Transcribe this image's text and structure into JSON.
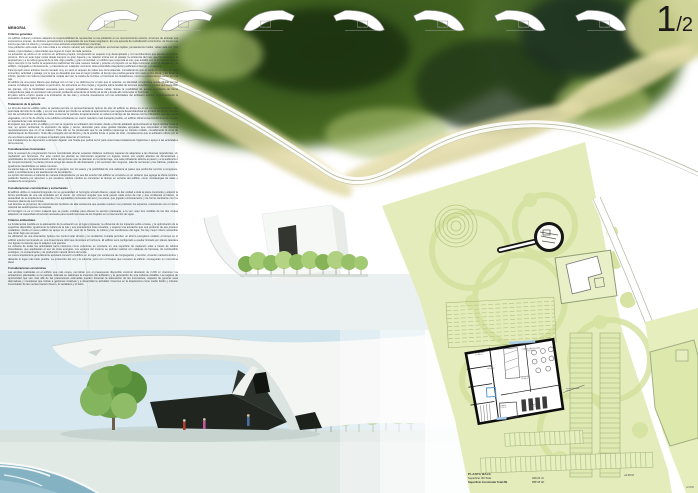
{
  "page": {
    "number_large": "1",
    "number_small": "/2"
  },
  "memoria": {
    "title": "MEMORIA",
    "sections": [
      {
        "heading": "Criterios generales",
        "body": "Un edificio cultural y turístico adquiere la responsabilidad de representar a una población en su reconocimiento exterior, al tiempo de articular sus expresiones propias, de distintos pensamientos e inquietudes de sus líneas singulares. Es una apuesta de revitalización económica, de frenar una inercia que late en silencio y conseguir unas acciones emprendedoras y lectoras.\nUna población está cada vez más unida a su entorno natural; son cuales permitirán economías tejidas, pensamientos bellos, vidas cada vez más reales, improvisadas y optimizadas que logran lo mejor de cada persona.\nLa actuación se ubica en un entorno sin atributos propios, recuperando un espacio muy desempleado y con servidumbres que afectan al entorno próximo. Pero en este lugar existe desde siempre su gran riqueza y su relación íntima con el paisaje: la existencia del mar, que ha inspirado a la arquitectura y a la cultura general de la isla. Algo posible y gran comunidad, un edificio que responda al mar, que entable con él un intenso diálogo como siempre lo ha hecho la arquitectura tradicional. De esta manera natural y potente el proyecto no se deja reconocer entre la naturaleza y el artificio, conjugado e intensamente, y entenderse en cualquier momento. Esta pretendida integración justificará el tiempo y el espacio.\nPara cumplir estos anhelos hemos tomado muy en serio el amparo de todas sus circunstancias. Consideramos que el suelo es un valor de vida, encuentro, actividad y paisaje, por lo que es deseable que sea el mayor posible, al tiempo que podría generar otro suelo a otra altura, y así llegar al infinito, percibir con toda la intensidad la mirada del mar, la caricia de la brisa, el horizonte sin limitaciones, como la problemática exterior de una isla.\nEl edificio es una pieza blanca que dialoga con el mar y se deforma por el aire que lo acaricia. La identidad constructiva queda diluida por las suaves curvaturas que modelan su perímetro. Se estructura en dos crujías y organiza sobre huellas de terrenos sensibles a medida que ascienden las plantas, con la flexibilidad necesaria para recoger actividades de diversa índole. Existe la posibilidad de acceso a cubierta de forma independiente para un acontecer más puntual, pudiendo extenderse al borde de la ola y desde allí contemplar el horizonte.\nEl palco sobre el arco queda a la inclinación de las olas y conecta visualmente con las actividades del anfiteatro exterior, experimentando la sensación de estar sobre el mar."
      },
      {
        "heading": "Tratamiento de la parcela",
        "body": "La fórmula dual de edificio sobre la parcela permite un aprovechamiento óptimo de ella. El edificio se alinea en el sur con la construcción más avanzada del sitio de la calle, y es por ese lateral por donde se accede al aparcamiento que seguirá desarrollándose en el talud del litoral, a limitar con las servidumbres vecinas que debe conservar la parcela. El aparcamiento se ordena al abrigo de las alturas con la ordenación que las plazas vegetadas, con el fin de ofrecer a los edificios colindantes un marco natural lo más tranquilo posible, un edificio oficial excepcionalmente de mesura en arquitecturas más domésticas.\nEl espacio que gira entre el edificio y el mar se organiza en anfiteatro del mirador, desde el borde asfaltado aprovechando el ligero declive hacia el mar; un aporte ambiental, la evocación de algas y arena, decorado para unas gradas blandas apoyadas que respondan a las diversas representaciones que en él se realicen. Para ello se ha preservado que la vía pública mantenga su tránsito rodado, considerando la zona de deslizamiento de liberación. Todo ello protegido del sol directo y de la posible lluvia. A pesar de todo, consideramos que el anfiteatro ofrece por la vía una buena parada en el paseo inmediato para observar el horizonte.\nLas instalaciones de depuración a demoler dejarán una huella que podría servir para unas losas-instalaciones higiénicas o apoyo a las actividades de la escena."
      },
      {
        "heading": "Consideraciones funcionales",
        "body": "Ante la escasez de programación hemos considerado ofrecer espacios diáfanos multiusos capaces de adaptarse a las diversas requisitorias, sin mediatizar sus funciones. Por este motivo las plantas se intencionan organizar en lugares únicos con amplio abanico de dimensiones y posibilidades de compartimentación. Entre las opciones que se plantean en la planta baja, una sala polivalente abierta al paseo y a la audiencia o de complementación; la planta primera acoge las áreas de administración y los servicios del congreso, sala de reuniones y las cabinas, pudiendo igualmente desdoblarse en salas menores.\nLa planta baja se ha destinado a restituir lo general, con los aseos y la posibilidad de una cafetería al paseo que podrá dar servicio a congresos, salón o sencillamente a los atardeceres de la población.\nLa opción del acceso a cubierta de manera independiente ya sea del exterior del edificio se convierte en un reclamo que agrega la oferta turística, pudiendo hacerlo por ascensor o por escalera. Ambos medios se convierten al tiempo en servicio del edificio, como montacargas de salas o escalera de emergencia."
      },
      {
        "heading": "Consideraciones constructivas y estructurales",
        "body": "El edificio utiliza un material integrado con su generalidad: el hormigón armado blanco, capaz de dar unidad a toda la pieza construida y adquirir la forma petrificada de una ola ondulada por el viento. Un volumen singular que será puesto cada verso de mar y que conllevará al blanco, la austeridad de la arquitectura vernácula y los agradables contrastes del azul y la arena, que jugarán continuamente y de forma cambiante con los sinuosos planos de sus límites.\nLas láminas se proponen de revestimientos fenólicos de alta resistencia que puedan resolver con precisión los espacios, resolviendo con el mismo material las autolimpiezas necesarias.\nEl hormigón no es el único material que se puede moldear para obtener la sección planteada, a la vez, aquí tres costillas de las dos crujías adquieren la capacidad estructural necesaria para resistir las losas de los forjados en la intervención de vigas."
      },
      {
        "heading": "Criterios ambientales",
        "body": "La fundamental medida es la adecuación de la actuación en el lugar propuesto, la eficiencia de los impactos sobre el área, y la optimización de la superficie disponible; igualmente la cultura de la isla y sus precedentes más resueltos, y esperar una actuación que sea producto de ese proceso cuidadoso, donde el nuevo edificio se apoye en el sitio: usos de la historia, la cultura y las condiciones del lugar. No hay mejor criterio sostenible que obrar bajo ese amparo.\nLa utilización de una orientación óptima con control solar térmico y la ventilación cruzada permiten un ahorro energético notable; el tiempo en el edificio exterior terminando en una línea blanca dócil que iluminará el horizonte. El edificio será configurado a quedar limitado por planos laterales con ligeras curvaturas que lo adapten a la parcela.\nLa cubierta de todas las actividades tanto interiores como exteriores se convierte en una superficie de captación solar a través de células fotovoltaicas, que aquilatarán el uso de otras energías. Los equipos del invierno se podrían realizar con calderas de biomasa, de combustible ecológico, no contaminante y de producción natural dentro de la isla.\nLa nueva arquitectura generalmente apostará convertir el edificio en el lugar por excelencia de congregación y reunión, creando mantenimientos y distando el lugar más bello posible. La protección del sol y la cubierta, junto con el bosque que envuelve al edificio, conseguirán un microclima ideal."
      },
      {
        "heading": "Consideraciones económicas",
        "body": "Las amplias realizadas en el edificio que más ocupa, permitirán con el presupuesto disponible construir alrededor de 2.200 m² interiores; las actuaciones planteadas en la parcela. Además se elaborará la inversión del anfiteatro y la generación de una cubierta visitable. Los lugares de oportunidad que van más allá de las pretensiones estimadas pueden fomentar la adecuación de las inversiones, capaces de generar esas alternativas y novedosas que invitan a gestiones creativas y a desarrollar la actividad. Creemos en la arquitectura como medio lúcido y cultural, incentivador de las mentes hacia lo bueno, lo verdadero y lo bello."
      }
    ]
  },
  "site_plan": {
    "rooms": [
      {
        "name": "Instalaciones",
        "area": "12.80 m²"
      },
      {
        "name": "Hall",
        "area": "44.20 m²"
      },
      {
        "name": "Cafetería Restaurante",
        "area": "105.85 m²"
      },
      {
        "name": "Exposición",
        "area": "65.80 m²"
      },
      {
        "name": "Cocina",
        "area": "19.10 m²"
      },
      {
        "name": "Aseos",
        "area": "15.40 m²"
      }
    ],
    "annotation": "acceso principal\n+0.00",
    "caption": {
      "title": "PLANTA BAJA",
      "lines": [
        {
          "label": "Superficie Útil Total",
          "value": "340.20 m²"
        },
        {
          "label": "Superficie Construida Total PB",
          "value": "377.17 m²"
        }
      ],
      "level_mark": "+0.00 M",
      "scale": "e/1250"
    }
  },
  "colors": {
    "forest_dark": "#1b300f",
    "forest_mid": "#577a2e",
    "leaf_light": "#a8bd6d",
    "sand": "#e3dcaa",
    "parcel": "#e3ecba",
    "sea": "#85b2c3",
    "sky": "#d7e8f0",
    "ink": "#3c3c3c"
  }
}
